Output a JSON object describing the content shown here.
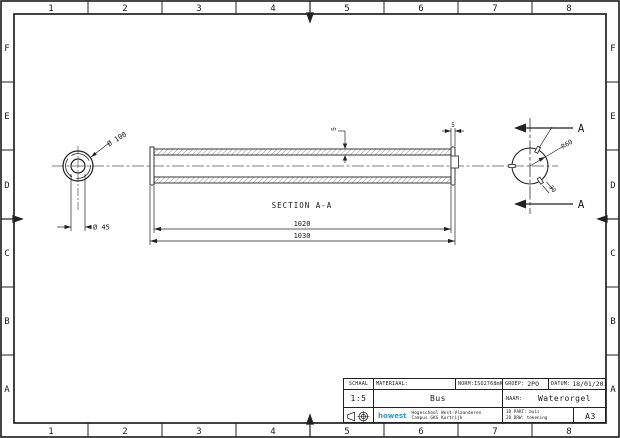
{
  "frame": {
    "columns": [
      "1",
      "2",
      "3",
      "4",
      "5",
      "6",
      "7",
      "8"
    ],
    "rows": [
      "F",
      "E",
      "D",
      "C",
      "B",
      "A"
    ]
  },
  "drawing": {
    "section_label": "SECTION A-A",
    "cut_label": "A",
    "dims": {
      "outer_diameter": "Ø 100",
      "bore_diameter": "Ø 45",
      "inner_length": "1020",
      "overall_length": "1030",
      "wall_thickness": "5",
      "end_width": "5",
      "radius": "R60",
      "slot_angle": "30"
    }
  },
  "title_block": {
    "schaal_label": "SCHAAL",
    "schaal_value": "1:5",
    "materiaal_label": "MATERIAAL:",
    "norm_label": "NORM:",
    "norm_value": "ISO2768mK",
    "groep_label": "GROEP:",
    "groep_value": "2PO",
    "datum_label": "DATUM:",
    "datum_value": "18/01/2016",
    "part_name": "Bus",
    "naam_label": "NAAM:",
    "naam_value": "Waterorgel",
    "logo_text": "howest",
    "school_line1": "Hogeschool West-Vlaanderen",
    "school_line2": "Campus GKG Kortrijk",
    "cad_line1": "3D PART: buis",
    "cad_line2": "2D DRW: tekening",
    "paper_format": "A3"
  },
  "colors": {
    "line": "#222222",
    "logo_blue": "#2e9bd6"
  }
}
